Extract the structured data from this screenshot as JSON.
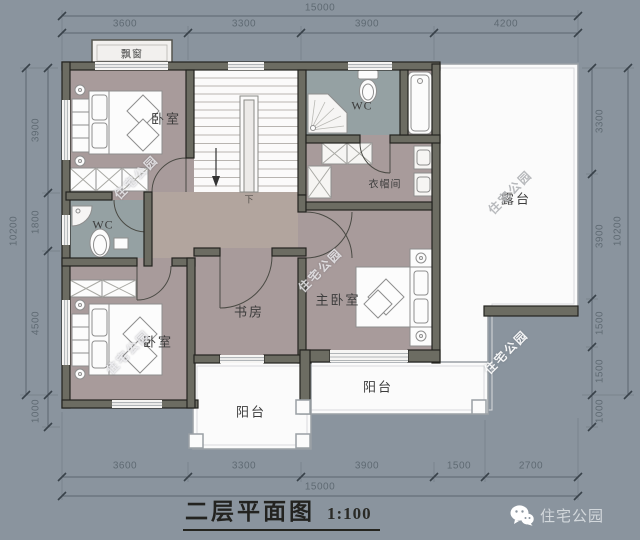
{
  "dims": {
    "top": {
      "total": "15000",
      "segments": [
        "3600",
        "3300",
        "3900",
        "4200"
      ]
    },
    "bottom": {
      "total": "15000",
      "segments": [
        "3600",
        "3300",
        "3900",
        "1500",
        "2700"
      ]
    },
    "left": {
      "total": "10200",
      "segments": [
        "3900",
        "1800",
        "4500",
        "1000"
      ]
    },
    "right": {
      "total": "10200",
      "segments": [
        "3300",
        "3900",
        "1500",
        "1500",
        "1000"
      ]
    }
  },
  "rooms": {
    "bay_window": "飘窗",
    "bedroom_top": "卧室",
    "wc_top": "WC",
    "cloakroom": "衣帽间",
    "terrace": "露台",
    "wc_left": "WC",
    "study": "书房",
    "master_bedroom": "主卧室",
    "bedroom_bottom": "卧室",
    "balcony_wide": "阳台",
    "balcony_small": "阳台",
    "stair_down": "下"
  },
  "caption": {
    "title": "二层平面图",
    "scale": "1:100"
  },
  "watermark": {
    "text": "住宅公园"
  },
  "logo": {
    "text": "住宅公园"
  },
  "colors": {
    "background": "#8a949e",
    "wall_fill": "#6c6c62",
    "wall_edge": "#23231f",
    "room_floor": "#a89b9b",
    "hall_floor": "#b2a59e",
    "wet_floor": "#95a1a3",
    "outdoor_floor": "#fbfbfb",
    "dimension_text": "#5f6a73",
    "label_text": "#3c3c3c",
    "caption_text": "#232320",
    "logo_text": "#d3d8dc"
  }
}
